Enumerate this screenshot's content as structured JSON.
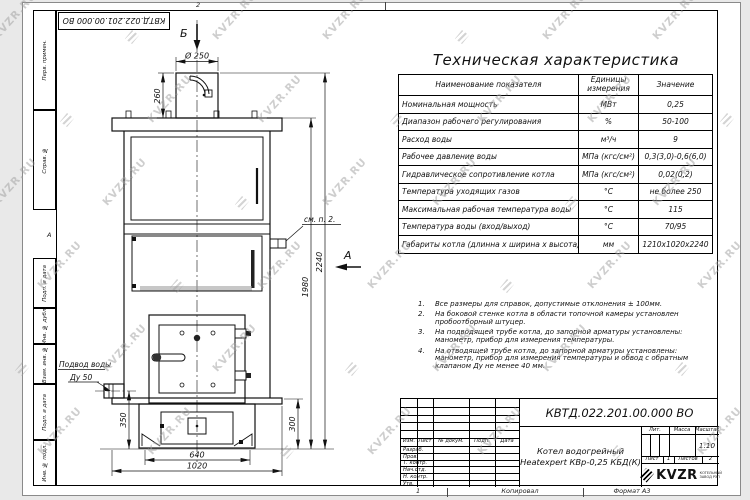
{
  "watermark": {
    "text": "KVZR.RU"
  },
  "top_stamp": "КВТД.022.201.00.000 ВО",
  "margins": {
    "top_zone": "2",
    "bottom_zone": "1",
    "zone_letter": "А",
    "copied": "Копировал",
    "format": "Формат А3"
  },
  "sidebar": {
    "labels": [
      "Перв. примен.",
      "Справ. №",
      "Подп. и дата",
      "Инв. № дубл.",
      "Взам. инв. №",
      "Подп. и дата",
      "Инв. № подл."
    ]
  },
  "drawing": {
    "view_b": "Б",
    "view_a": "А",
    "callout": "см. п. 2.",
    "pipe_label_1": "Подвод воды",
    "pipe_label_2": "Ду 50",
    "dims": {
      "d250": "Ø 250",
      "h260": "260",
      "h2240": "2240",
      "h1980": "1980",
      "h350": "350",
      "h300": "300",
      "w640": "640",
      "w1020": "1020"
    }
  },
  "tech": {
    "title": "Техническая характеристика",
    "headers": [
      "Наименование показателя",
      "Единицы измерения",
      "Значение"
    ],
    "rows": [
      [
        "Номинальная мощность",
        "МВт",
        "0,25"
      ],
      [
        "Диапазон рабочего регулирования",
        "%",
        "50-100"
      ],
      [
        "Расход воды",
        "м³/ч",
        "9"
      ],
      [
        "Рабочее давление воды",
        "МПа (кгс/см²)",
        "0,3(3,0)-0,6(6,0)"
      ],
      [
        "Гидравлическое сопротивление котла",
        "МПа (кгс/см²)",
        "0,02(0,2)"
      ],
      [
        "Температура уходящих газов",
        "°С",
        "не более 250"
      ],
      [
        "Максимальная рабочая температура воды",
        "°С",
        "115"
      ],
      [
        "Температура воды (вход/выход)",
        "°С",
        "70/95"
      ],
      [
        "Габариты котла (длинна х ширина х высота)",
        "мм",
        "1210х1020х2240"
      ]
    ]
  },
  "notes": [
    "Все размеры для справок, допустимые отклонения ± 100мм.",
    "На боковой стенке котла в области топочной камеры установлен пробоотборный штуцер.",
    "На подводящей трубе котла, до запорной арматуры установлены: манометр, прибор для измерения температуры.",
    "На отводящей трубе котла, до запорной арматуры установлены: манометр, прибор для измерения температуры и обвод с обратным клапаном Ду не менее 40 мм."
  ],
  "title_block": {
    "doc_number": "КВТД.022.201.00.000 ВО",
    "product_line1": "Котел водогрейный",
    "product_line2": "Heatexpert КВр-0,25 КБД(К)",
    "cols": [
      "Изм.",
      "Лист",
      "№ докум.",
      "Подп.",
      "Дата"
    ],
    "roles": [
      "Разраб.",
      "Пров.",
      "Т. контр.",
      "Нач.отд.",
      "Н. контр.",
      "Утв."
    ],
    "lit_label": "Лит.",
    "mass_label": "Масса",
    "scale_label": "Масштаб",
    "scale_value": "1:10",
    "sheet_label": "Лист",
    "sheet_value": "1",
    "sheets_label": "Листов",
    "sheets_value": "2",
    "logo": {
      "name": "KVZR",
      "line1": "КОТЕЛЬНЫЙ",
      "line2": "ЗАВОД РЭП"
    }
  }
}
